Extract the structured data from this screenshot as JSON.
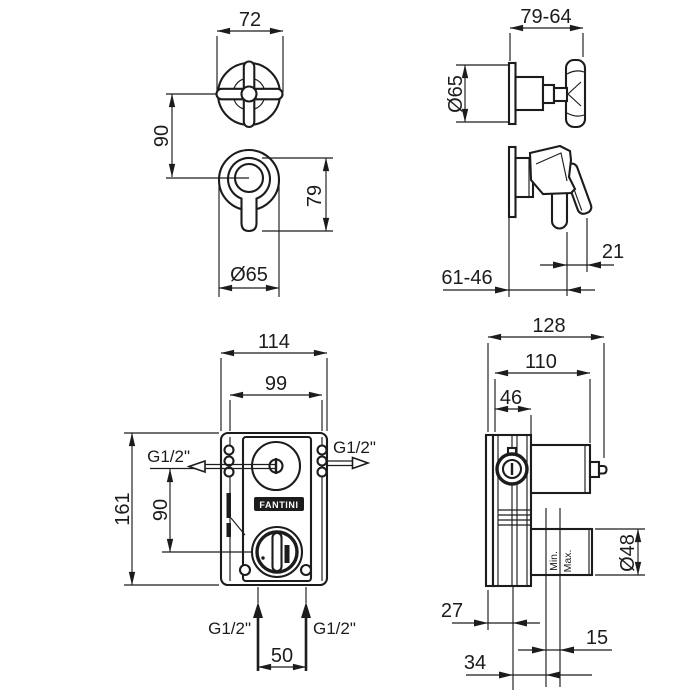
{
  "drawing": {
    "type": "technical-dimension-drawing",
    "product": "concealed shower mixer with handles",
    "colors": {
      "line": "#1c1c1c",
      "background": "#ffffff"
    }
  },
  "brand": {
    "logo": "FANTINI"
  },
  "dims": {
    "cross_width": "72",
    "front_center_gap": "90",
    "lever_span": "79",
    "front_plate_dia": "Ø65",
    "side_depth_range": "79-64",
    "side_plate_dia": "Ø65",
    "lever_overhang": "21",
    "lever_depth_range": "61-46",
    "body_overall_width": "114",
    "body_inner_width": "99",
    "body_height": "161",
    "port_center_gap": "90",
    "inlet_spacing": "50",
    "depth_overall": "128",
    "depth_box": "110",
    "depth_front": "46",
    "outlet_dia": "Ø48",
    "wall_offset_back": "27",
    "wall_thickness_range": "15",
    "center_to_wall": "34"
  },
  "ports": {
    "side_left": "G1/2\"",
    "side_right": "G1/2\"",
    "bottom_left": "G1/2\"",
    "bottom_right": "G1/2\""
  },
  "wall_refs": {
    "min": "Min.",
    "max": "Max."
  }
}
